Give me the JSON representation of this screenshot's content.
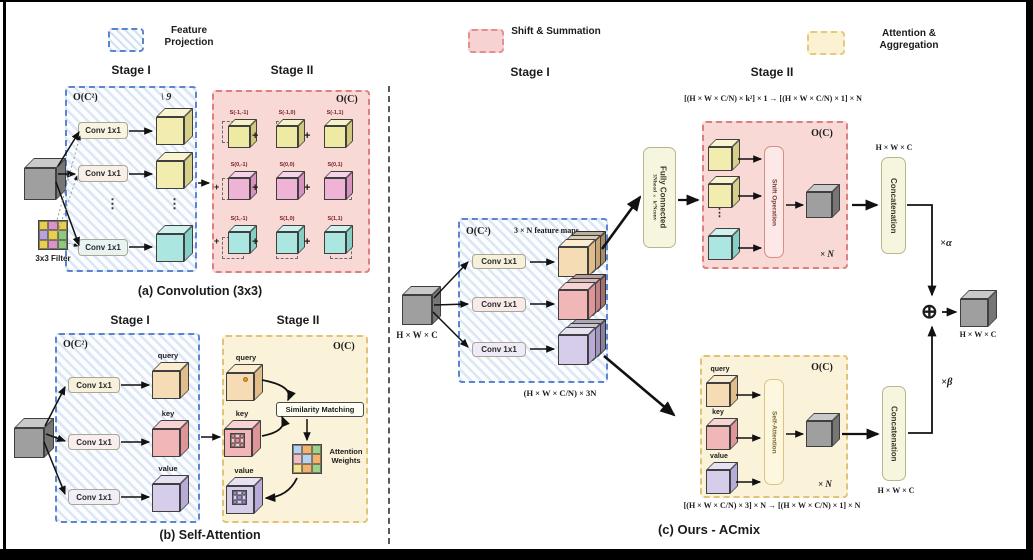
{
  "legend": {
    "feature_projection": "Feature Projection",
    "shift_summation": "Shift & Summation",
    "attention_aggregation": "Attention & Aggregation"
  },
  "misc": {
    "ellipsis": "⋮",
    "plus": "+",
    "oplus": "⊕"
  },
  "panel_a": {
    "stage1": "Stage I",
    "stage2": "Stage II",
    "complexity1": "O(C²)",
    "complexity2": "O(C)",
    "kernel_note": "\\ 9",
    "conv": [
      "Conv 1x1",
      "Conv 1x1",
      "Conv 1x1"
    ],
    "filter_label": "3x3 Filter",
    "shift_labels": [
      [
        "S(-1,-1)",
        "S(-1,0)",
        "S(-1,1)"
      ],
      [
        "S(0,-1)",
        "S(0,0)",
        "S(0,1)"
      ],
      [
        "S(1,-1)",
        "S(1,0)",
        "S(1,1)"
      ]
    ],
    "caption": "(a) Convolution (3x3)"
  },
  "panel_b": {
    "stage1": "Stage I",
    "stage2": "Stage II",
    "complexity1": "O(C²)",
    "complexity2": "O(C)",
    "conv": [
      "Conv 1x1",
      "Conv 1x1",
      "Conv 1x1"
    ],
    "query": "query",
    "key": "key",
    "value": "value",
    "similarity": "Similarity Matching",
    "attention_weights": "Attention Weights",
    "caption": "(b) Self-Attention"
  },
  "panel_c": {
    "stage1": "Stage I",
    "stage2": "Stage II",
    "complexity1": "O(C²)",
    "feature_maps": "3 × N feature maps",
    "input_dim": "H × W × C",
    "conv": [
      "Conv 1x1",
      "Conv 1x1",
      "Conv 1x1"
    ],
    "stage1_out_dim": "(H × W × C/N) × 3N",
    "fc_title": "Fully Connected",
    "fc_sub": "3Nhead × k²Nconv",
    "conv_branch": {
      "formula": "[(H × W × C/N) × k²] × 1  →  [(H × W × C/N) × 1] × N",
      "complexity": "O(C)",
      "shift_op": "Shift Operation",
      "times_n": "× N"
    },
    "attn_branch": {
      "complexity": "O(C)",
      "query": "query",
      "key": "key",
      "value": "value",
      "self_attention": "Self-Attention",
      "times_n": "× N",
      "formula": "[(H × W × C/N) × 3] × N  →  [(H × W × C/N) × 1] × N"
    },
    "concat_top": {
      "label": "Concatenation",
      "dim": "H × W × C",
      "scale": "×α"
    },
    "concat_bottom": {
      "label": "Concatenation",
      "dim": "H × W × C",
      "scale": "×β"
    },
    "output_dim": "H × W × C",
    "caption": "(c) Ours - ACmix"
  },
  "palette": {
    "accent_blue": "#5b86cf",
    "accent_red": "#dd7f7f",
    "accent_yellow": "#dfc376",
    "filter_grid": [
      "#e7cf52",
      "#d895c5",
      "#e7cf52",
      "#b9a3dd",
      "#e7cf52",
      "#8fc87e",
      "#e7cf52",
      "#d895c5",
      "#8fc87e"
    ],
    "attention_grid": [
      "#b9d3ec",
      "#f2b36e",
      "#9ed28c",
      "#f2bec6",
      "#b9d3ec",
      "#f2b36e",
      "#f5e48e",
      "#f2b36e",
      "#9ed28c"
    ],
    "key_pattern": [
      "#e2898e",
      "#f4caca",
      "#e2898e",
      "#f4caca",
      "#e2898e",
      "#f4caca",
      "#e2898e",
      "#f4caca",
      "#e2898e"
    ],
    "value_pattern": [
      "#9d8bc8",
      "#d9d0ec",
      "#9d8bc8",
      "#d9d0ec",
      "#9d8bc8",
      "#d9d0ec",
      "#9d8bc8",
      "#d9d0ec",
      "#9d8bc8"
    ]
  }
}
